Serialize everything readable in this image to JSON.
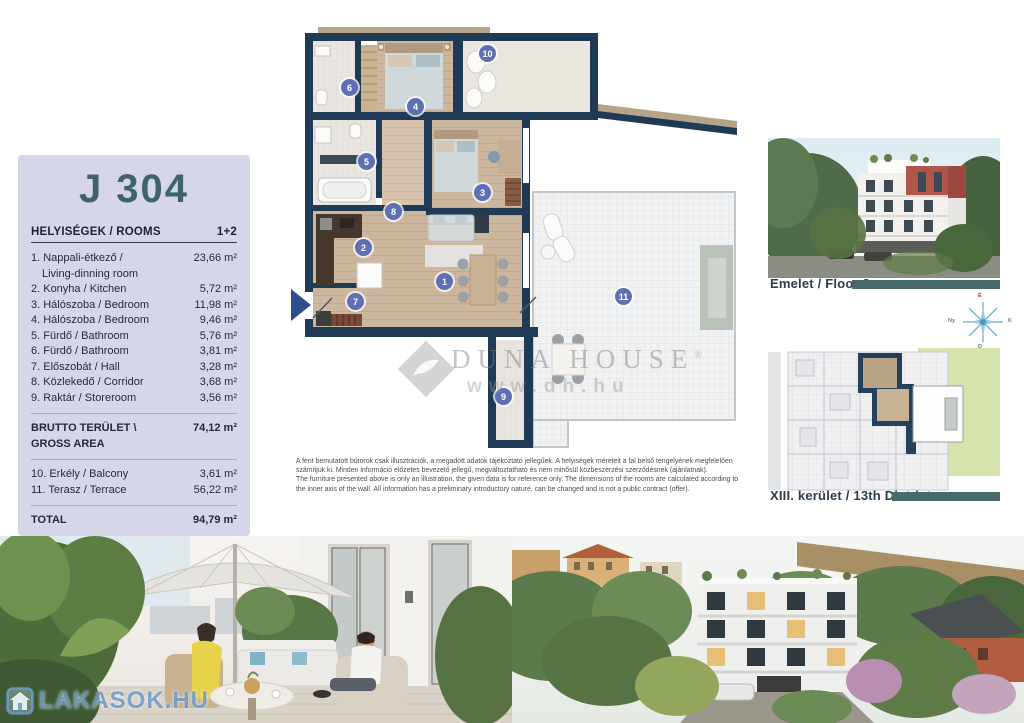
{
  "panel": {
    "title": "J 304",
    "rooms_header": "HELYISÉGEK / ROOMS",
    "rooms_type": "1+2",
    "rooms": [
      {
        "label": "1. Nappali-étkező /",
        "label2": "Living-dinning room",
        "area": "23,66 m²"
      },
      {
        "label": "2. Konyha / Kitchen",
        "area": "5,72 m²"
      },
      {
        "label": "3. Hálószoba / Bedroom",
        "area": "11,98 m²"
      },
      {
        "label": "4. Hálószoba / Bedroom",
        "area": "9,46 m²"
      },
      {
        "label": "5. Fürdő / Bathroom",
        "area": "5,76 m²"
      },
      {
        "label": "6. Fürdő / Bathroom",
        "area": "3,81 m²"
      },
      {
        "label": "7. Előszobát / Hall",
        "area": "3,28 m²"
      },
      {
        "label": "8. Közlekedő / Corridor",
        "area": "3,68 m²"
      },
      {
        "label": "9. Raktár / Storeroom",
        "area": "3,56 m²"
      }
    ],
    "gross_label": "BRUTTO TERÜLET \\",
    "gross_label2": "GROSS AREA",
    "gross_area": "74,12 m²",
    "outdoor": [
      {
        "label": "10. Erkély / Balcony",
        "area": "3,61 m²"
      },
      {
        "label": "11. Terasz / Terrace",
        "area": "56,22 m²"
      }
    ],
    "total_label": "TOTAL",
    "total_area": "94,79 m²"
  },
  "floorplan": {
    "markers": [
      "1",
      "2",
      "3",
      "4",
      "5",
      "6",
      "7",
      "8",
      "9",
      "10",
      "11"
    ]
  },
  "captions": {
    "floor_photo": "Emelet / Floor 3",
    "district_plan": "XIII. kerület / 13th District",
    "street": "Jász u. / Jász st."
  },
  "compass": {
    "n": "É",
    "e": "K",
    "s": "D",
    "w": "Ny"
  },
  "disclaimer": {
    "hu": "A fent bemutatott bútorok csak illusztrációk, a megadott adatok tájékoztató jellegűek. A helyiségek méreteit a fal belső tengelyének megfelelően számítjuk ki. Minden információ előzetes bevezető jellegű, megváltoztatható és nem minősül közbeszerzési szerződésnek (ajánlatnak).",
    "en": "The furniture presented above is only an illustration, the given data is for reference only. The dimensions of the rooms are calculated according to the inner axis of the wall. All information has a preliminary introductory nature, can be changed and is not a public contract (offer)."
  },
  "watermarks": {
    "dunahouse_brand": "DUNA HOUSE",
    "dunahouse_reg": "®",
    "dunahouse_url": "www.dh.hu",
    "lakasok": "LAKASOK.HU"
  },
  "colors": {
    "panel_bg": "#d5d7e9",
    "title": "#3f6366",
    "accent_bar": "#486a6d",
    "wall_navy": "#1e3a55",
    "marker_blue": "#5f6fb4",
    "site_green": "#d5e3ac",
    "watermark_blue": "#4d86c0"
  }
}
